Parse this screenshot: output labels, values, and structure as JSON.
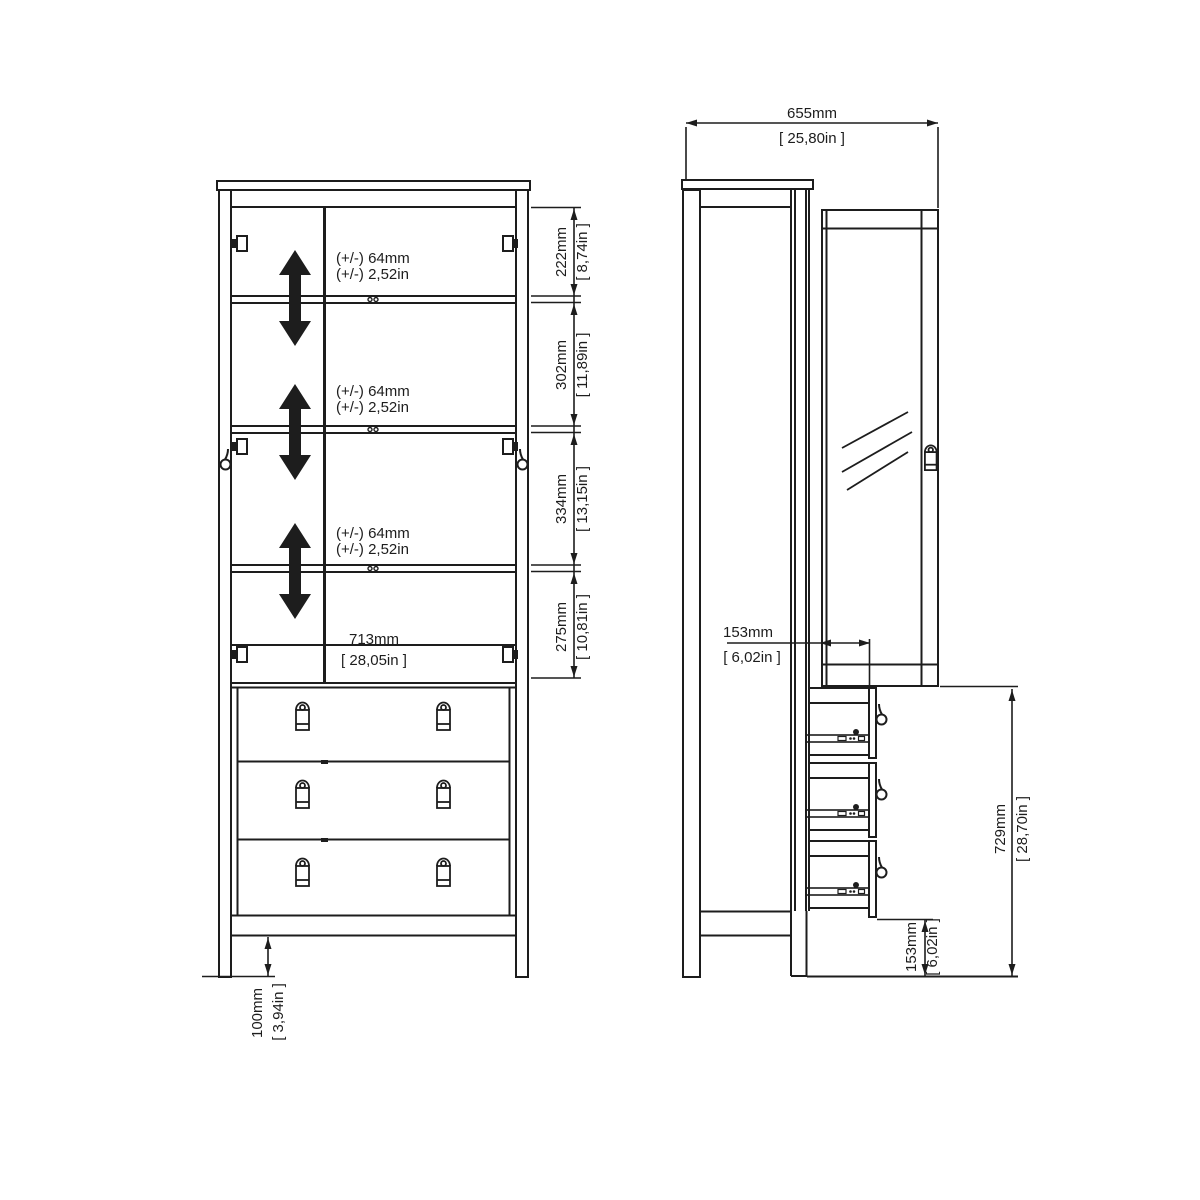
{
  "front_view": {
    "adjust_note_mm": "(+/-) 64mm",
    "adjust_note_in": "(+/-) 2,52in",
    "dim_222_mm": "222mm",
    "dim_222_in": "[ 8,74in ]",
    "dim_302_mm": "302mm",
    "dim_302_in": "[ 11,89in ]",
    "dim_334_mm": "334mm",
    "dim_334_in": "[ 13,15in ]",
    "dim_275_mm": "275mm",
    "dim_275_in": "[ 10,81in ]",
    "dim_713_mm": "713mm",
    "dim_713_in": "[ 28,05in ]",
    "dim_100_mm": "100mm",
    "dim_100_in": "[ 3,94in ]"
  },
  "side_view": {
    "dim_655_mm": "655mm",
    "dim_655_in": "[ 25,80in ]",
    "dim_153_top_mm": "153mm",
    "dim_153_top_in": "[ 6,02in ]",
    "dim_729_mm": "729mm",
    "dim_729_in": "[ 28,70in ]",
    "dim_153_bot_mm": "153mm",
    "dim_153_bot_in": "[ 6,02in ]"
  },
  "line_color": "#1d1d1d"
}
